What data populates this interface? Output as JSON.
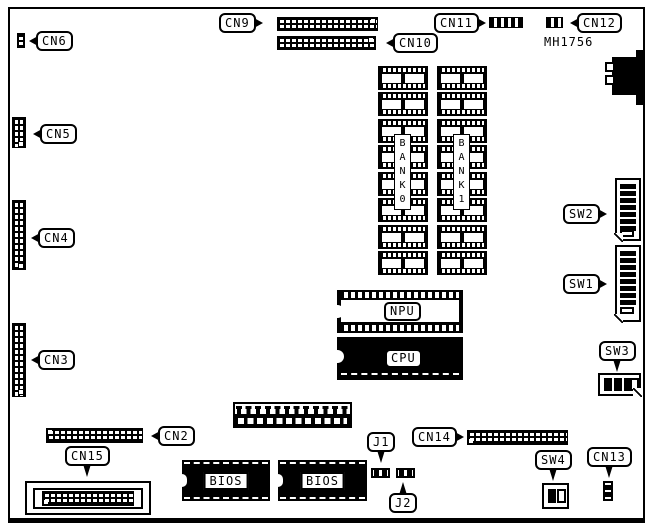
{
  "diagram": {
    "part_number": "MH1756",
    "callouts": {
      "cn2": "CN2",
      "cn3": "CN3",
      "cn4": "CN4",
      "cn5": "CN5",
      "cn6": "CN6",
      "cn9": "CN9",
      "cn10": "CN10",
      "cn11": "CN11",
      "cn12": "CN12",
      "cn13": "CN13",
      "cn14": "CN14",
      "cn15": "CN15",
      "j1": "J1",
      "j2": "J2",
      "sw1": "SW1",
      "sw2": "SW2",
      "sw3": "SW3",
      "sw4": "SW4"
    },
    "chips": {
      "npu": "NPU",
      "cpu": "CPU",
      "bios1": "BIOS",
      "bios2": "BIOS",
      "bank0": "BANK0",
      "bank1": "BANK1"
    },
    "colors": {
      "line": "#000000",
      "background": "#ffffff"
    }
  }
}
